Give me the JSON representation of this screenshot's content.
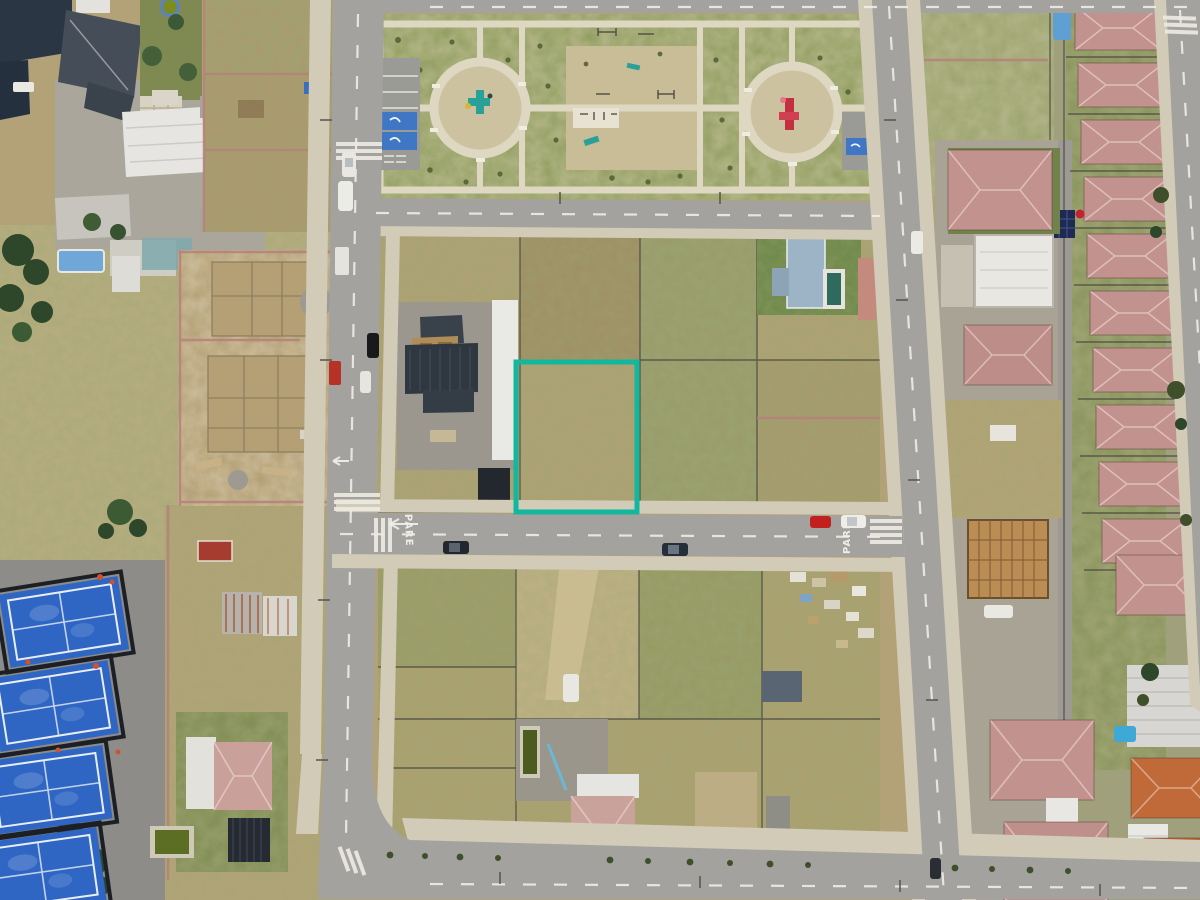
{
  "meta": {
    "title": "Aerial drone view of a new residential subdivision with a teal-highlighted vacant lot for sale"
  },
  "scene": {
    "road_marking_text": "PARE",
    "highlight_lot": {
      "x": 516,
      "y": 362,
      "width": 121,
      "height": 150,
      "outline_color": "#12b79e",
      "outline_width": 5
    },
    "palette": {
      "dirt": "#b3a277",
      "dry_grass": "#b8ad80",
      "park_grass": "#8f9c5e",
      "road": "#a3a29e",
      "sidewalk": "#d2cbb8",
      "roof_pink": "#c2938e",
      "roof_orange": "#c06a39",
      "roof_dark": "#2f3740",
      "court_blue": "#2f66c4",
      "pool_teal": "#49c2c4",
      "wall_pink": "#b5837b",
      "playground_teal": "#2aa198",
      "playground_red": "#c4303f",
      "car_red": "#c21f1f"
    },
    "features": {
      "park_playground_circles": 2,
      "padel_courts_visible": 4,
      "highlighted_lot_label": "highlighted-lot"
    }
  }
}
